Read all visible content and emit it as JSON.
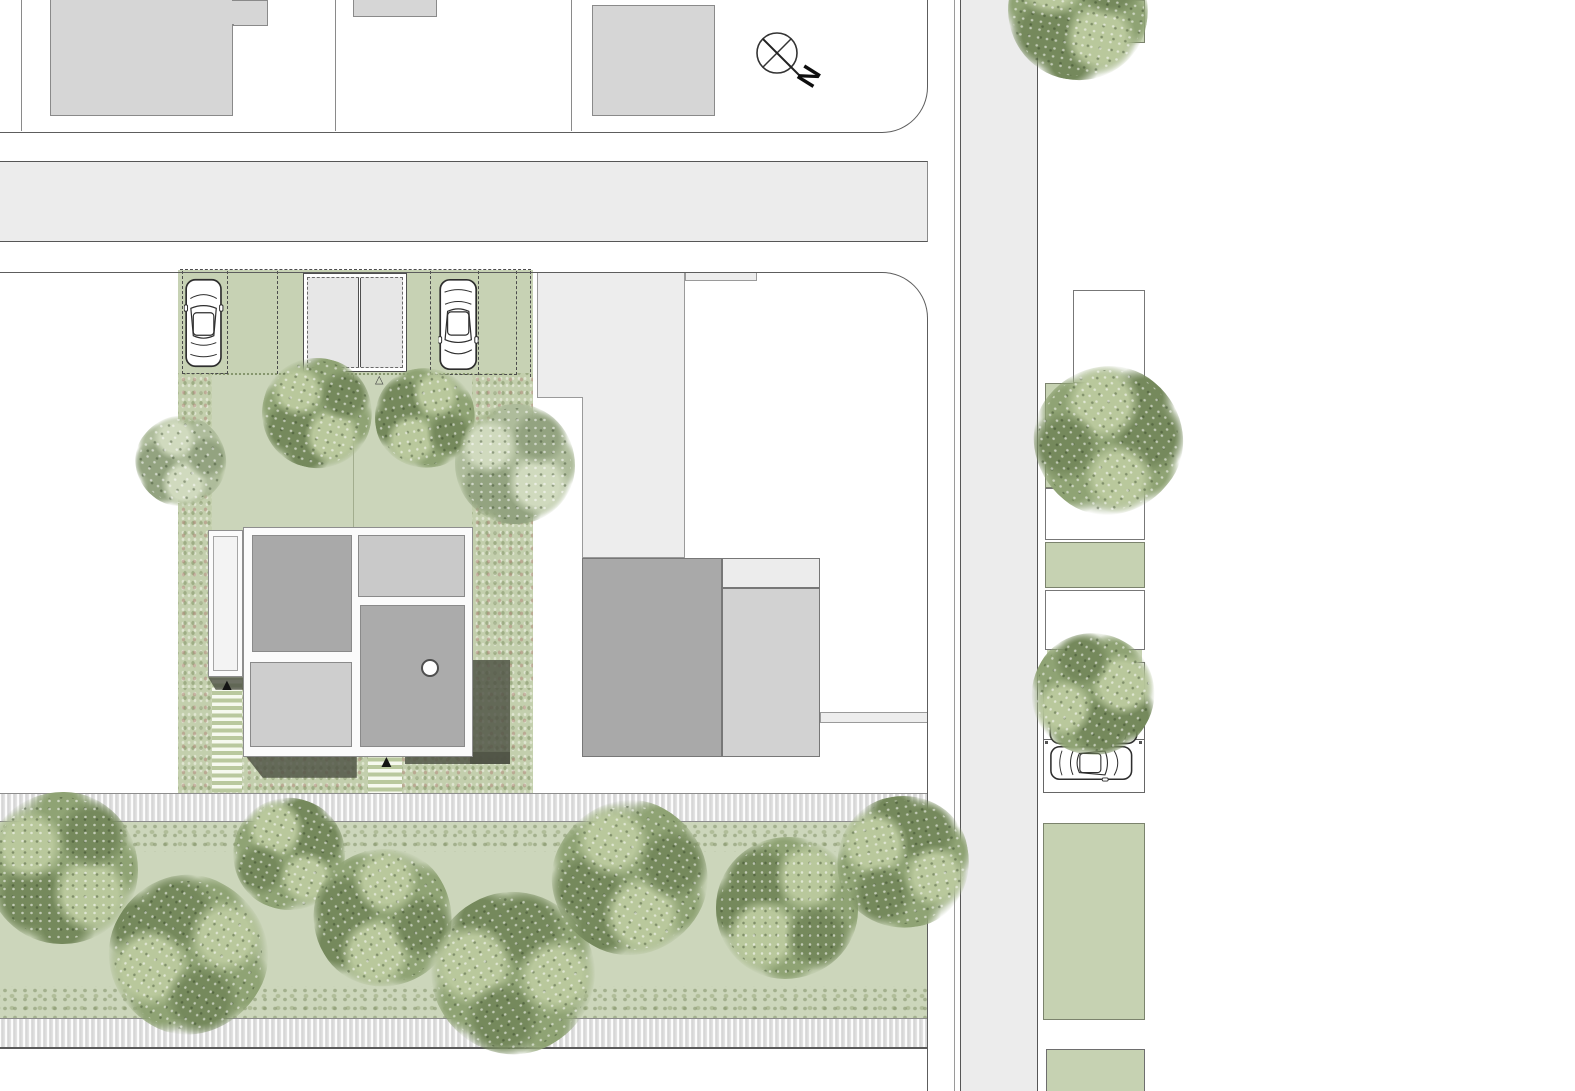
{
  "compass": {
    "label": "N"
  },
  "markers": {
    "entry_glyph": "▲",
    "garage_glyph": "△"
  },
  "palette": {
    "road_gray": "#ececec",
    "lawn_green": "#cbd5ba",
    "parking_green": "#c7d2b4",
    "parcel_green": "#c6d2b2",
    "wild_planting": "#c3cfad",
    "building_fill": "#d6d6d6",
    "neighbor_dark_gray": "#a9a9a9",
    "neighbor_light_gray": "#d2d2d2",
    "roof_dark_gray": "#a9a9a9",
    "roof_light_gray": "#c9c9c9",
    "shadow_gray": "#4e5244",
    "outline_gray": "#5d5d5d"
  },
  "trees": [
    {
      "x": 317,
      "y": 413,
      "r": 55,
      "tone": "green",
      "rot": 15
    },
    {
      "x": 425,
      "y": 418,
      "r": 50,
      "tone": "green",
      "rot": 80
    },
    {
      "x": 515,
      "y": 464,
      "r": 60,
      "tone": "pale",
      "rot": 0
    },
    {
      "x": 181,
      "y": 461,
      "r": 45,
      "tone": "pale",
      "rot": 40
    },
    {
      "x": 62,
      "y": 868,
      "r": 76,
      "tone": "green",
      "rot": 0
    },
    {
      "x": 188,
      "y": 955,
      "r": 79,
      "tone": "green",
      "rot": 120
    },
    {
      "x": 289,
      "y": 854,
      "r": 56,
      "tone": "green",
      "rot": 200
    },
    {
      "x": 383,
      "y": 918,
      "r": 69,
      "tone": "green",
      "rot": 60
    },
    {
      "x": 513,
      "y": 973,
      "r": 81,
      "tone": "green",
      "rot": 150
    },
    {
      "x": 630,
      "y": 878,
      "r": 77,
      "tone": "green",
      "rot": 30
    },
    {
      "x": 787,
      "y": 908,
      "r": 71,
      "tone": "green",
      "rot": 90
    },
    {
      "x": 903,
      "y": 862,
      "r": 66,
      "tone": "green",
      "rot": 170
    },
    {
      "x": 1078,
      "y": 10,
      "r": 70,
      "tone": "green",
      "rot": 10
    },
    {
      "x": 1108,
      "y": 440,
      "r": 74,
      "tone": "green",
      "rot": 220
    },
    {
      "x": 1093,
      "y": 694,
      "r": 61,
      "tone": "green",
      "rot": 300
    }
  ],
  "cars": [
    {
      "cx": 204,
      "cy": 323,
      "len": 90,
      "rot": 0
    },
    {
      "cx": 458,
      "cy": 324,
      "len": 93,
      "rot": 180
    },
    {
      "cx": 1094,
      "cy": 726,
      "len": 90,
      "rot": 270
    },
    {
      "cx": 1091,
      "cy": 763,
      "len": 84,
      "rot": 90
    }
  ]
}
